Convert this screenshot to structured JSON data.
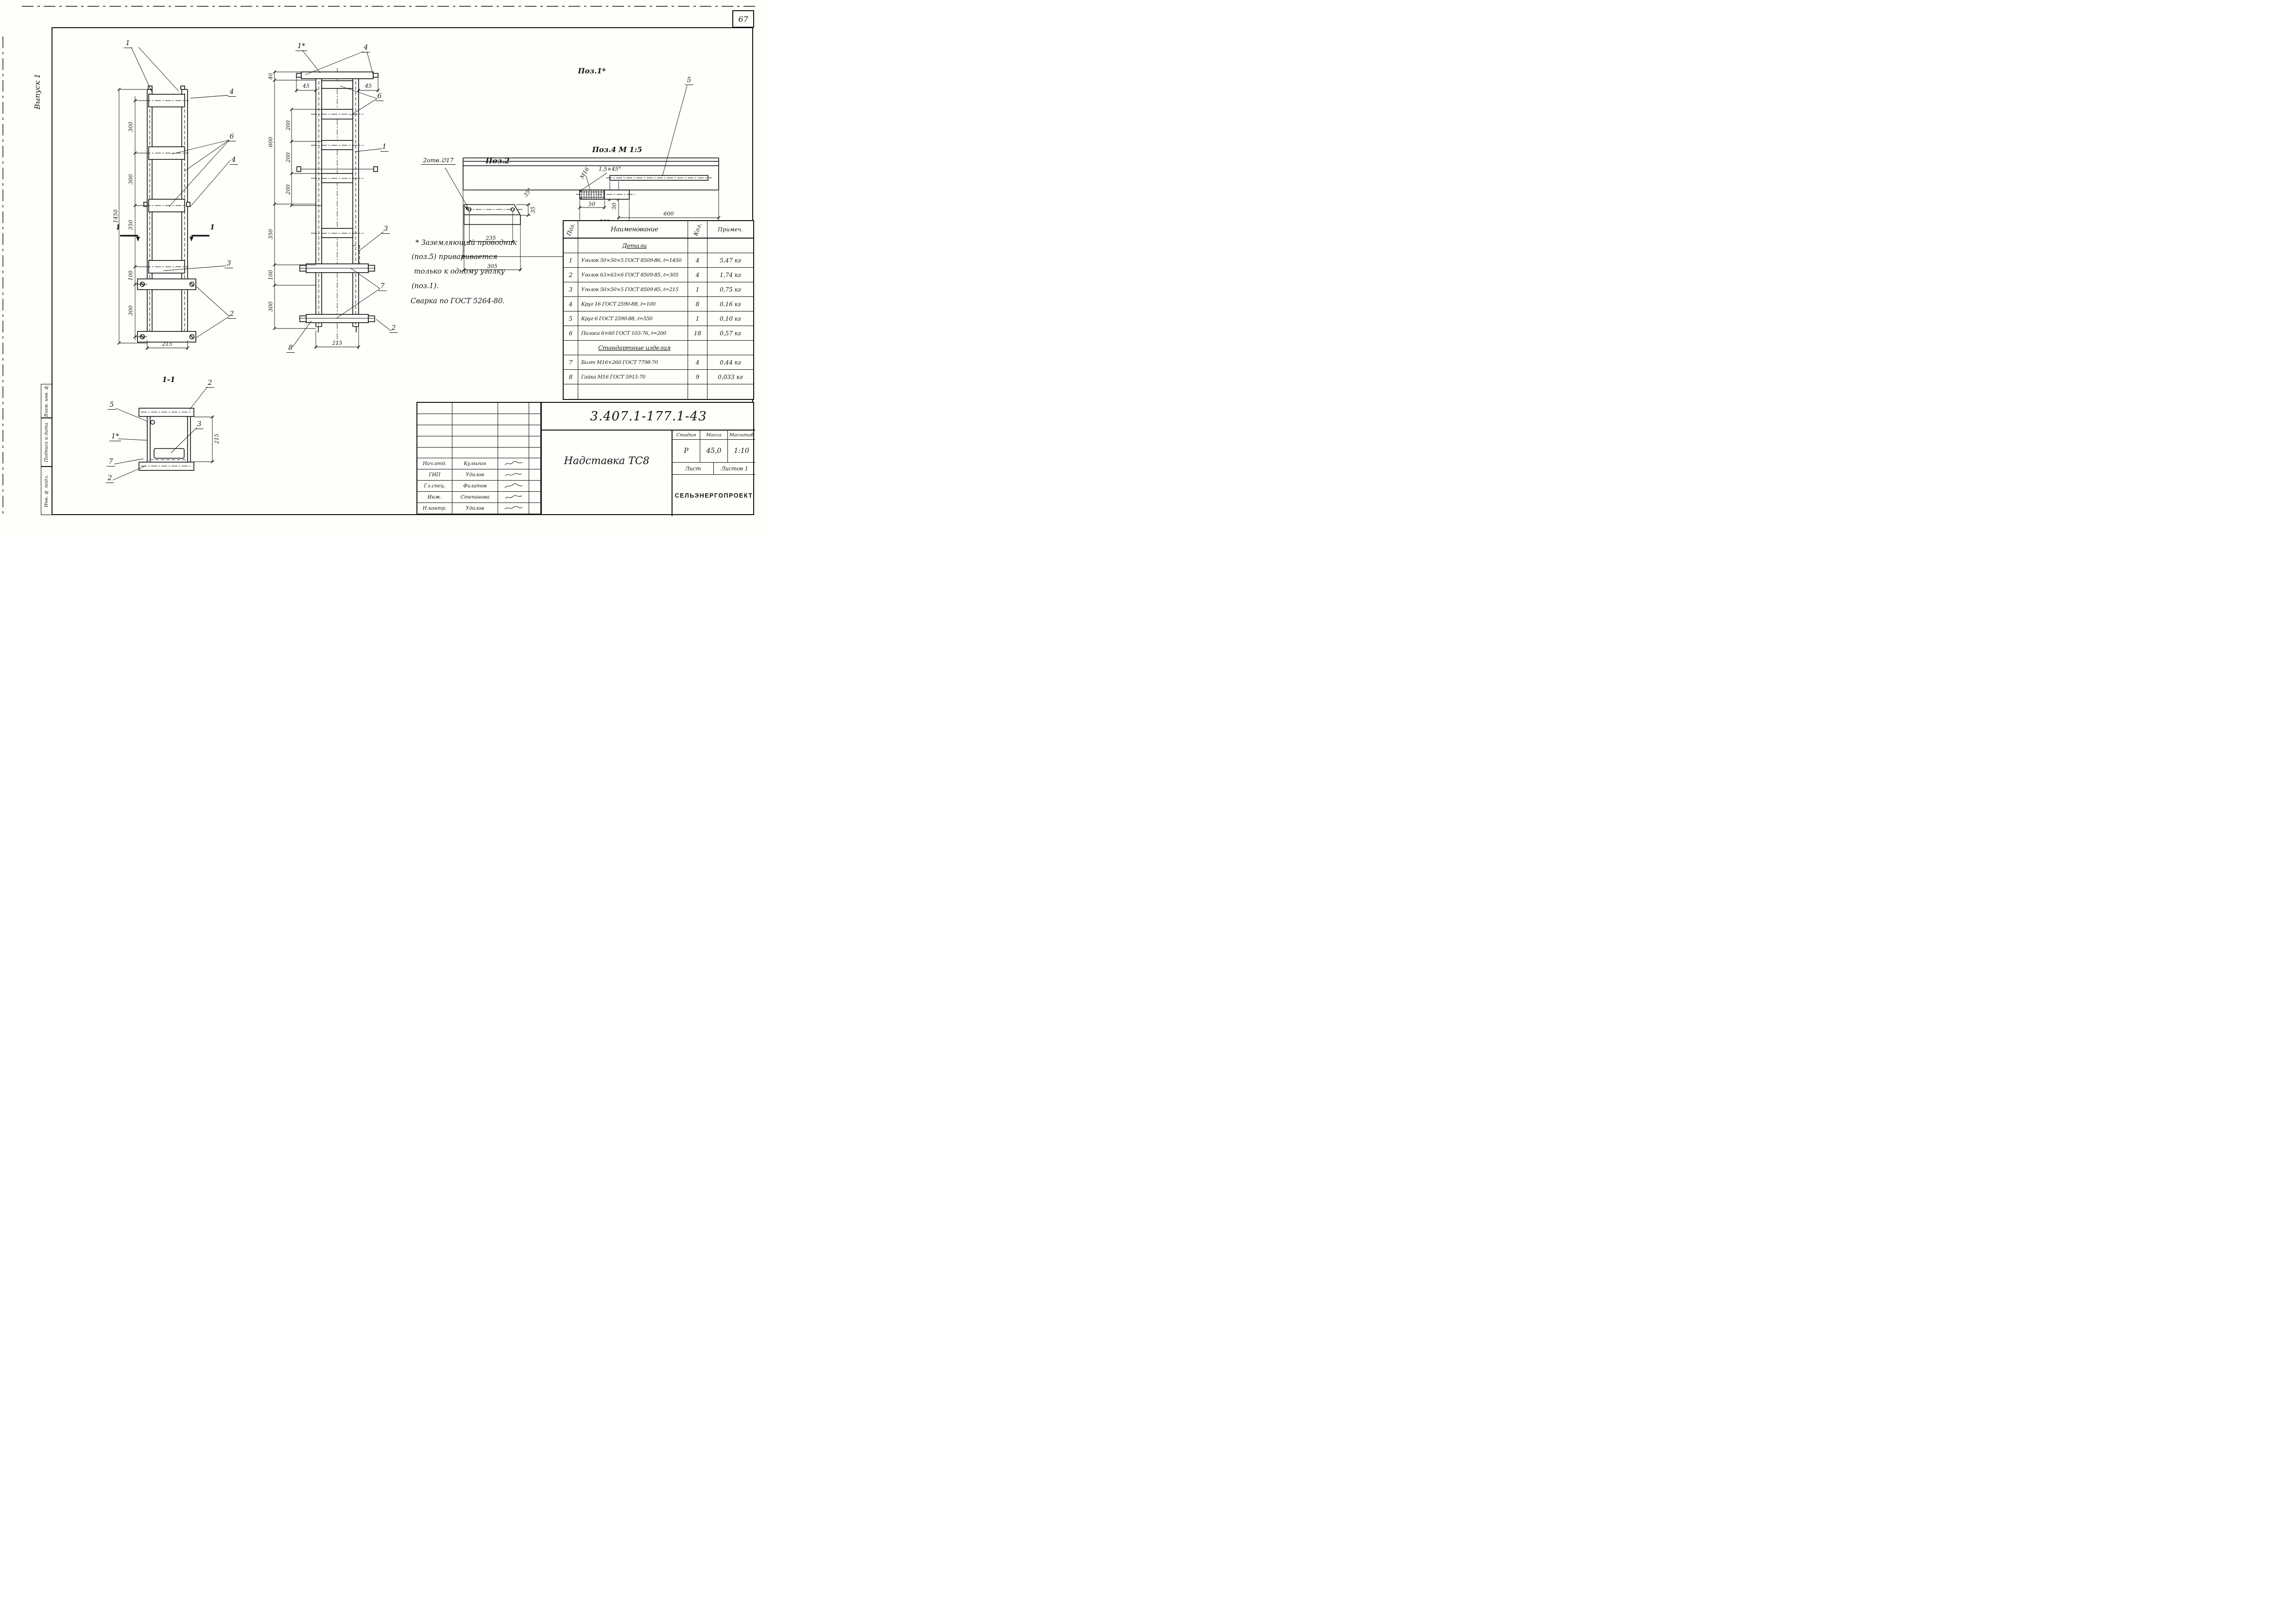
{
  "page": {
    "number": "67",
    "issue": "Выпуск 1"
  },
  "side_stamp": {
    "fields": [
      "Взам. инв. №",
      "Подпись и дата",
      "Инв. № подл."
    ]
  },
  "note": {
    "lines": [
      "* Заземляющий проводник",
      "(поз.5) приваривается",
      "только к одному уголку",
      "(поз.1).",
      "Сварка по ГОСТ 5264-80."
    ]
  },
  "views": {
    "front": {
      "dims": {
        "total": "1450",
        "segs": [
          "300",
          "300",
          "350",
          "100",
          "300"
        ],
        "width": "215"
      },
      "callouts": {
        "one": "1",
        "four_top": "4",
        "six": "6",
        "four_mid": "4",
        "three": "3",
        "two": "2"
      },
      "section_mark": "1"
    },
    "side": {
      "dims": {
        "top": "40",
        "left": [
          "600",
          "350",
          "100",
          "300"
        ],
        "inner": [
          "200",
          "200",
          "200"
        ],
        "width": "215",
        "offset_left": "45",
        "offset_right": "45"
      },
      "callouts": {
        "one_star": "1*",
        "four": "4",
        "six": "6",
        "one": "1",
        "three": "3",
        "seven": "7",
        "two": "2",
        "eight": "8"
      }
    },
    "section": {
      "title": "1-1",
      "dims": {
        "width": "215"
      },
      "callouts": {
        "two_top": "2",
        "five": "5",
        "one_star": "1*",
        "seven": "7",
        "two_bottom": "2",
        "three": "3"
      }
    },
    "pos1": {
      "title": "Поз.1*",
      "callout_five": "5",
      "dims": {
        "d50": "50",
        "d600": "600",
        "d1450": "1450"
      }
    },
    "pos2": {
      "title": "Поз.2",
      "holes_note": "2отв.∅17",
      "dims": {
        "d235": "235",
        "d305": "305",
        "d35": "35",
        "angle": "35°"
      }
    },
    "pos4": {
      "title": "Поз.4  М 1:5",
      "labels": {
        "thread": "М16",
        "chamfer": "1,5×45°"
      },
      "dims": {
        "d50": "50",
        "d100": "100"
      }
    }
  },
  "parts_table": {
    "headers": [
      "Поз.",
      "Наименование",
      "Кол.",
      "Примеч."
    ],
    "group1": "Детали",
    "group2": "Стандартные изделия",
    "rows": [
      {
        "pos": "1",
        "name": "Уголок 50×50×5 ГОСТ 8509-86, ℓ=1450",
        "qty": "4",
        "note": "5,47 кг"
      },
      {
        "pos": "2",
        "name": "Уголок 63×63×6 ГОСТ 8509-85, ℓ=305",
        "qty": "4",
        "note": "1,74 кг"
      },
      {
        "pos": "3",
        "name": "Уголок 50×50×5 ГОСТ 8509-85, ℓ=215",
        "qty": "1",
        "note": "0,75 кг"
      },
      {
        "pos": "4",
        "name": "Круг 16 ГОСТ 2590-88, ℓ=100",
        "qty": "8",
        "note": "0,16 кг"
      },
      {
        "pos": "5",
        "name": "Круг 6 ГОСТ 2590-88, ℓ=550",
        "qty": "1",
        "note": "0,10 кг"
      },
      {
        "pos": "6",
        "name": "Полоса 6×60 ГОСТ 103-76, ℓ=200",
        "qty": "18",
        "note": "0,57 кг"
      },
      {
        "pos": "7",
        "name": "Болт М16×260 ГОСТ 7798-70",
        "qty": "4",
        "note": "0,44 кг"
      },
      {
        "pos": "8",
        "name": "Гайка М16 ГОСТ 5915-70",
        "qty": "9",
        "note": "0,033 кг"
      }
    ]
  },
  "title_block": {
    "doc_number": "3.407.1-177.1-43",
    "product": "Надставка ТС8",
    "stage_label": "Стадия",
    "mass_label": "Масса",
    "scale_label": "Масштаб",
    "stage": "Р",
    "mass": "45,0",
    "scale": "1:10",
    "sheet_label": "Лист",
    "sheets_label": "Листов 1",
    "organization": "СЕЛЬЭНЕРГОПРОЕКТ",
    "signatures": [
      {
        "role": "Нач.отд.",
        "name": "Кулыгин"
      },
      {
        "role": "ГИП",
        "name": "Удалов"
      },
      {
        "role": "Гл.спец.",
        "name": "Филатов"
      },
      {
        "role": "Инж.",
        "name": "Степанова"
      },
      {
        "role": "Н.контр.",
        "name": "Удалов"
      }
    ]
  }
}
